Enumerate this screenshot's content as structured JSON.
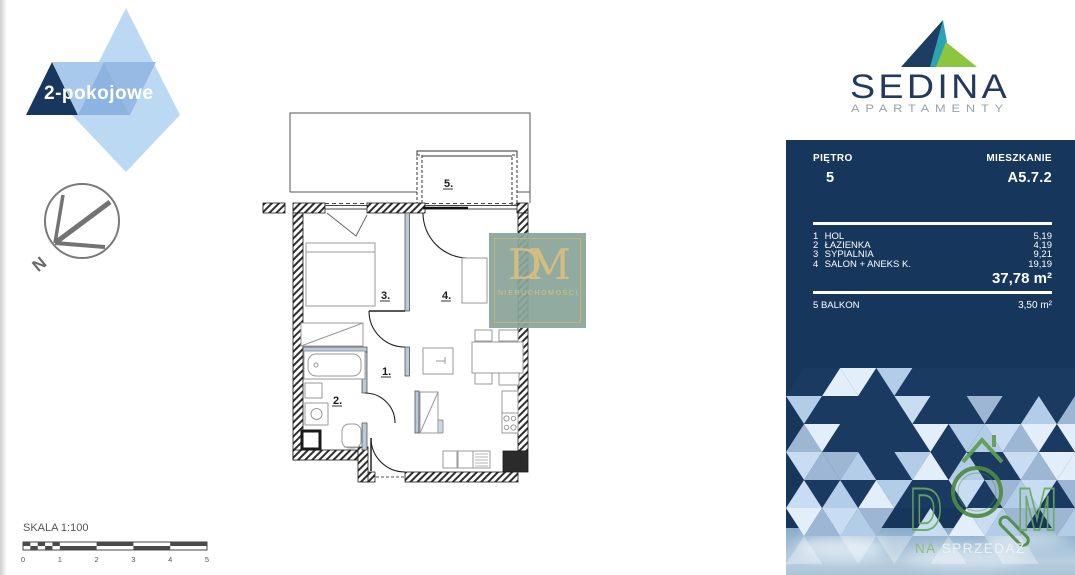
{
  "badge": {
    "label": "2-pokojowe"
  },
  "compass": {
    "label": "N"
  },
  "brand": {
    "name": "SEDINA",
    "subtitle": "APARTAMENTY"
  },
  "panel": {
    "floor_label": "PIĘTRO",
    "floor_value": "5",
    "unit_label": "MIESZKANIE",
    "unit_value": "A5.7.2",
    "rooms": [
      {
        "no": "1",
        "name": "HOL",
        "area": "5,19"
      },
      {
        "no": "2",
        "name": "ŁAZIENKA",
        "area": "4,19"
      },
      {
        "no": "3",
        "name": "SYPIALNIA",
        "area": "9,21"
      },
      {
        "no": "4",
        "name": "SALON + ANEKS K.",
        "area": "19,19"
      }
    ],
    "total_area": "37,78 m²",
    "balcony": {
      "no": "5",
      "name": "BALKON",
      "area": "3,50 m²"
    }
  },
  "plan": {
    "labels": {
      "hall": "1.",
      "bath": "2.",
      "bedroom": "3.",
      "salon": "4.",
      "balcony": "5."
    }
  },
  "watermark": {
    "monogram": "DM",
    "caption": "NIERUCHOMOŚCI"
  },
  "scale": {
    "label": "SKALA 1:100",
    "ticks": [
      "0",
      "1",
      "2",
      "3",
      "4",
      "5"
    ]
  },
  "footer_logo": {
    "word_d": "D",
    "word_m": "M",
    "caption_na": "NA",
    "caption_sprzedaz": "SPRZEDAŻ"
  },
  "colors": {
    "panel_navy": "#17365c",
    "brand_navy": "#24395e",
    "brand_teal": "#2ba3b4",
    "brand_green": "#8cc63f",
    "dom_green": "#5f9e4e",
    "gold": "#c9b176",
    "mosaic_palette": {
      "navy": "#1b3a61",
      "light": "#c9ddf2",
      "medium": "#9db6d4",
      "pale": "#e2eef9",
      "mid2": "#b3cde9"
    }
  }
}
